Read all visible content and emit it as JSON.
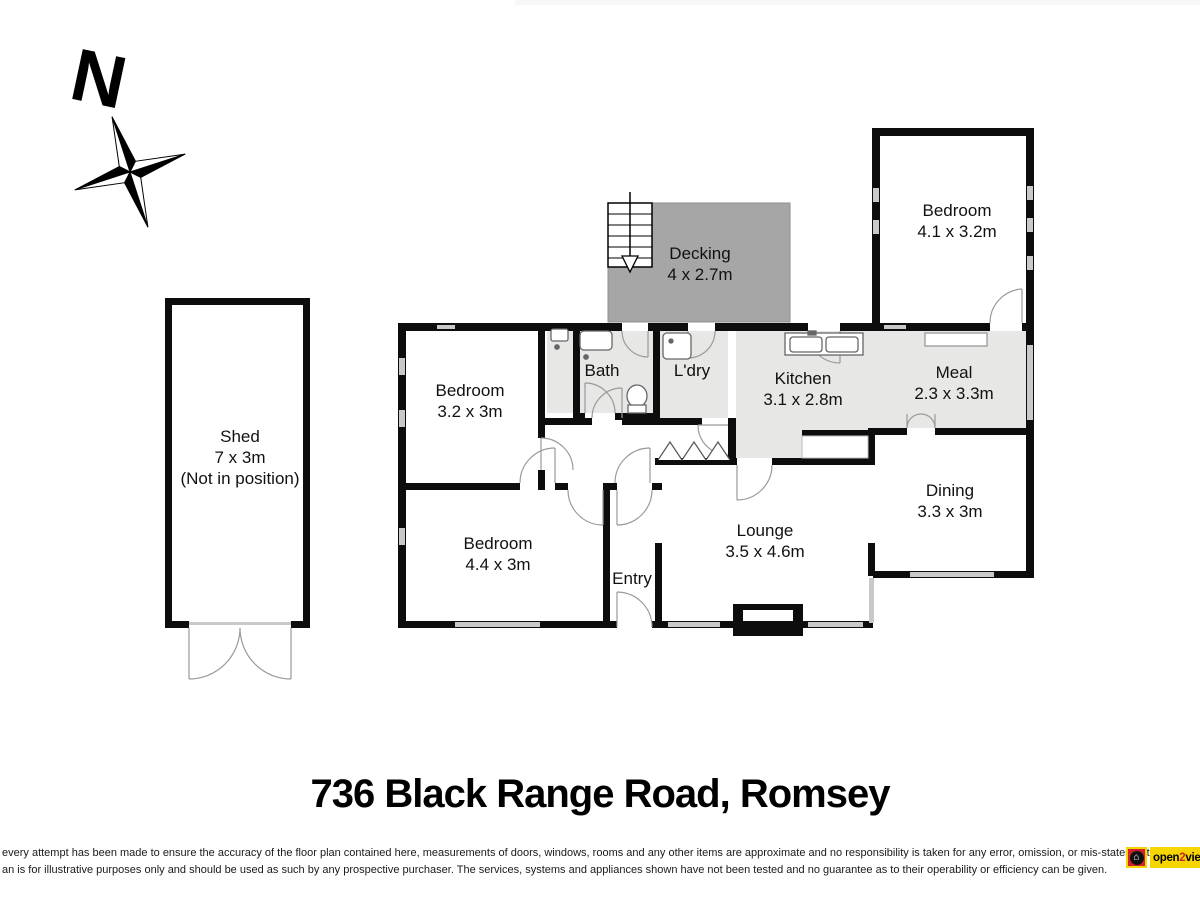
{
  "title": "736 Black Range Road, Romsey",
  "compass": {
    "north_label": "N"
  },
  "rooms": {
    "shed": {
      "name": "Shed",
      "dims": "7 x 3m",
      "note": "(Not in position)"
    },
    "decking": {
      "name": "Decking",
      "dims": "4 x 2.7m"
    },
    "bedroom_ne": {
      "name": "Bedroom",
      "dims": "4.1 x 3.2m"
    },
    "bedroom_w": {
      "name": "Bedroom",
      "dims": "3.2 x 3m"
    },
    "bath": {
      "name": "Bath"
    },
    "laundry": {
      "name": "L'dry"
    },
    "kitchen": {
      "name": "Kitchen",
      "dims": "3.1 x 2.8m"
    },
    "meal": {
      "name": "Meal",
      "dims": "2.3 x 3.3m"
    },
    "dining": {
      "name": "Dining",
      "dims": "3.3 x 3m"
    },
    "lounge": {
      "name": "Lounge",
      "dims": "3.5 x 4.6m"
    },
    "entry": {
      "name": "Entry"
    },
    "bedroom_sw": {
      "name": "Bedroom",
      "dims": "4.4 x 3m"
    }
  },
  "disclaimer": {
    "line1": "every attempt has been made to ensure the accuracy of the floor plan contained here, measurements of doors, windows, rooms and any other items are approximate and no responsibility is taken for any error, omission, or mis-statement.",
    "line2": "an is for illustrative purposes only and should be used as such by any prospective purchaser. The services, systems and appliances shown have not been tested and no guarantee as to their operability or efficiency can be given."
  },
  "logo": {
    "open": "open",
    "two": "2",
    "view": "view"
  },
  "icons": [
    "compass-star-icon",
    "stairs-down-icon",
    "fireplace-icon",
    "toilet-icon",
    "bath-sink-icon",
    "shower-mixer-icon",
    "laundry-tub-icon",
    "kitchen-double-sink-icon",
    "door-swing-arc",
    "window-marker",
    "open2view-house-icon"
  ],
  "colors": {
    "wall": "#0d0d0d",
    "decking_fill": "#a6a6a6",
    "wet_area_fill": "#e7e7e5",
    "window_marker": "#c9c9c9",
    "door_arc": "#9a9a9a",
    "logo_yellow": "#f6d500",
    "logo_red": "#d2232a",
    "top_strip": "#f7f7f8"
  }
}
